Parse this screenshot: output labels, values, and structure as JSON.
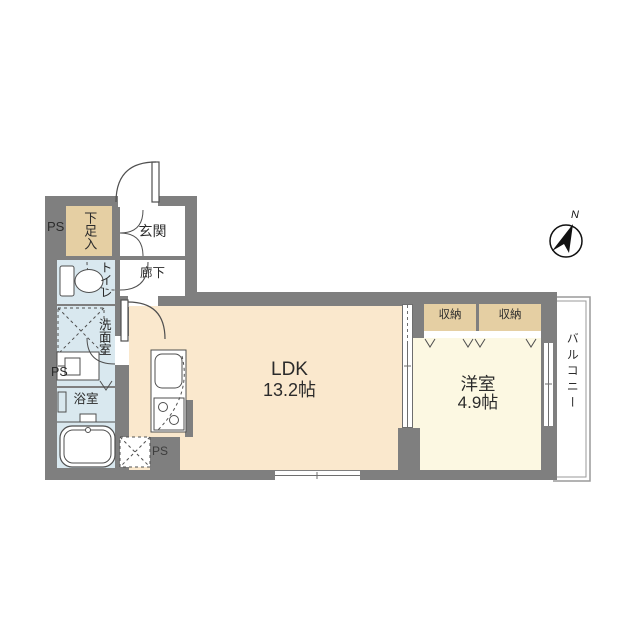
{
  "compass": {
    "north_label": "N"
  },
  "ps_labels": [
    "PS",
    "PS",
    "PS"
  ],
  "rooms": {
    "ldk": {
      "name": "LDK",
      "size": "13.2帖"
    },
    "western_room": {
      "name": "洋室",
      "size": "4.9帖"
    },
    "entrance": {
      "label": "玄関"
    },
    "hallway": {
      "label": "廊下"
    },
    "toilet": {
      "label": "トイレ"
    },
    "washroom": {
      "label": "洗面室"
    },
    "bathroom": {
      "label": "浴室"
    },
    "shoe_storage": {
      "label": "下足入"
    },
    "storage_left": {
      "label": "収納"
    },
    "storage_right": {
      "label": "収納"
    },
    "balcony": {
      "label": "バルコニー"
    }
  },
  "colors": {
    "wall": "#7f7f7f",
    "ldk_floor": "#fae8cd",
    "western_floor": "#fcf8e2",
    "storage_fill": "#e5cfa3",
    "wet_area": "#d9e8ef",
    "text": "#2b2b2b"
  }
}
